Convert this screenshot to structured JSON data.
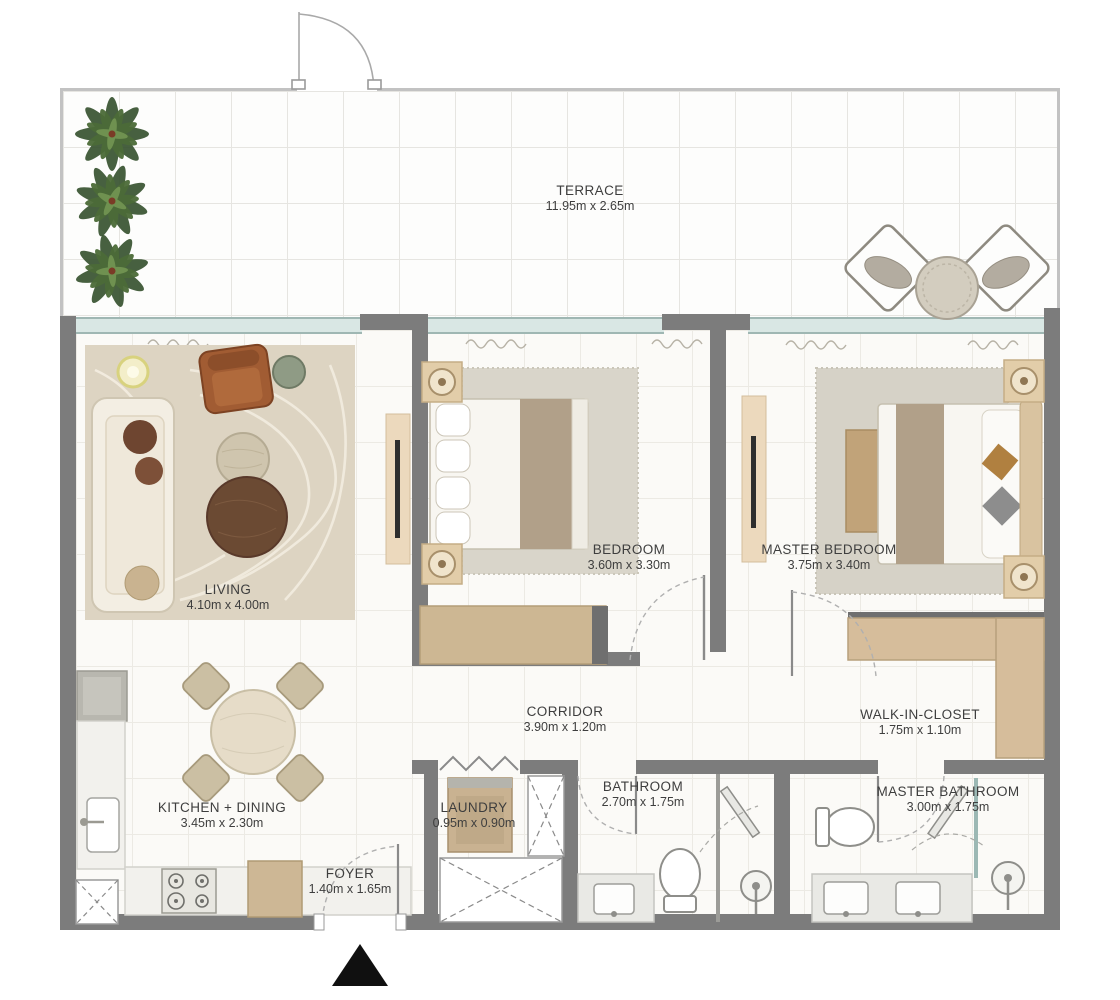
{
  "plan": {
    "type": "apartment-floor-plan",
    "rooms": {
      "terrace": {
        "name": "TERRACE",
        "dims": "11.95m x 2.65m"
      },
      "living": {
        "name": "LIVING",
        "dims": "4.10m x 4.00m"
      },
      "bedroom": {
        "name": "BEDROOM",
        "dims": "3.60m x 3.30m"
      },
      "master_bedroom": {
        "name": "MASTER BEDROOM",
        "dims": "3.75m x 3.40m"
      },
      "corridor": {
        "name": "CORRIDOR",
        "dims": "3.90m x 1.20m"
      },
      "walk_in_closet": {
        "name": "WALK-IN-CLOSET",
        "dims": "1.75m x 1.10m"
      },
      "kitchen_dining": {
        "name": "KITCHEN + DINING",
        "dims": "3.45m x 2.30m"
      },
      "laundry": {
        "name": "LAUNDRY",
        "dims": "0.95m x 0.90m"
      },
      "bathroom": {
        "name": "BATHROOM",
        "dims": "2.70m x 1.75m"
      },
      "master_bathroom": {
        "name": "MASTER BATHROOM",
        "dims": "3.00m x 1.75m"
      },
      "foyer": {
        "name": "FOYER",
        "dims": "1.40m x 1.65m"
      }
    },
    "icons": {
      "entrance_marker": "black-triangle-up",
      "plant": "palm-plant-top-view",
      "door_swing": "quarter-arc",
      "closet": "dashed-x-box"
    },
    "colors": {
      "wall": "#7c7c7c",
      "parapet": "#c2c2c2",
      "glazing": "#d9e7e4",
      "wood": "#d6bd9b",
      "rug": "#ddd4c2",
      "sofa": "#f3eee3",
      "armchair": "#a15c33",
      "plant": "#34502c",
      "label_text": "#3e3e3e",
      "entrance": "#101010"
    }
  }
}
